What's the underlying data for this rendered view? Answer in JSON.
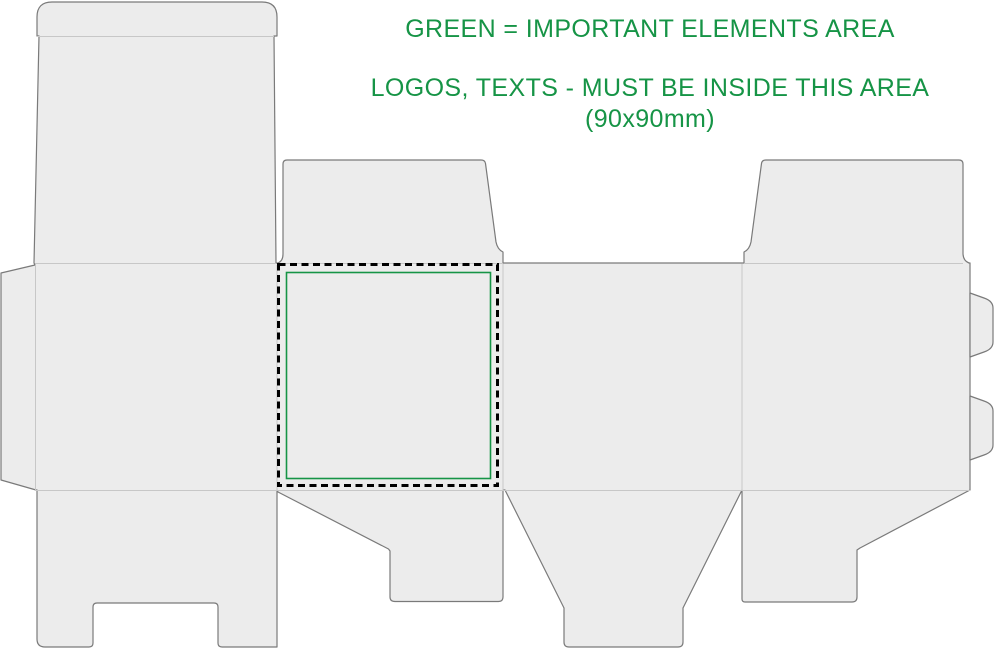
{
  "notes": {
    "line1": "GREEN = IMPORTANT ELEMENTS AREA",
    "line2": "LOGOS, TEXTS - MUST BE INSIDE THIS AREA",
    "line3": "(90x90mm)"
  },
  "safe_area": {
    "size_label": "90x90mm",
    "border_style_outer": "black dashed",
    "border_style_inner": "green solid"
  },
  "colors": {
    "green": "#169446",
    "panel_fill": "#ececec",
    "cut_line": "#7a7a7a",
    "fold_line": "#c7c7c7",
    "dash_line": "#000000",
    "background": "#ffffff"
  }
}
